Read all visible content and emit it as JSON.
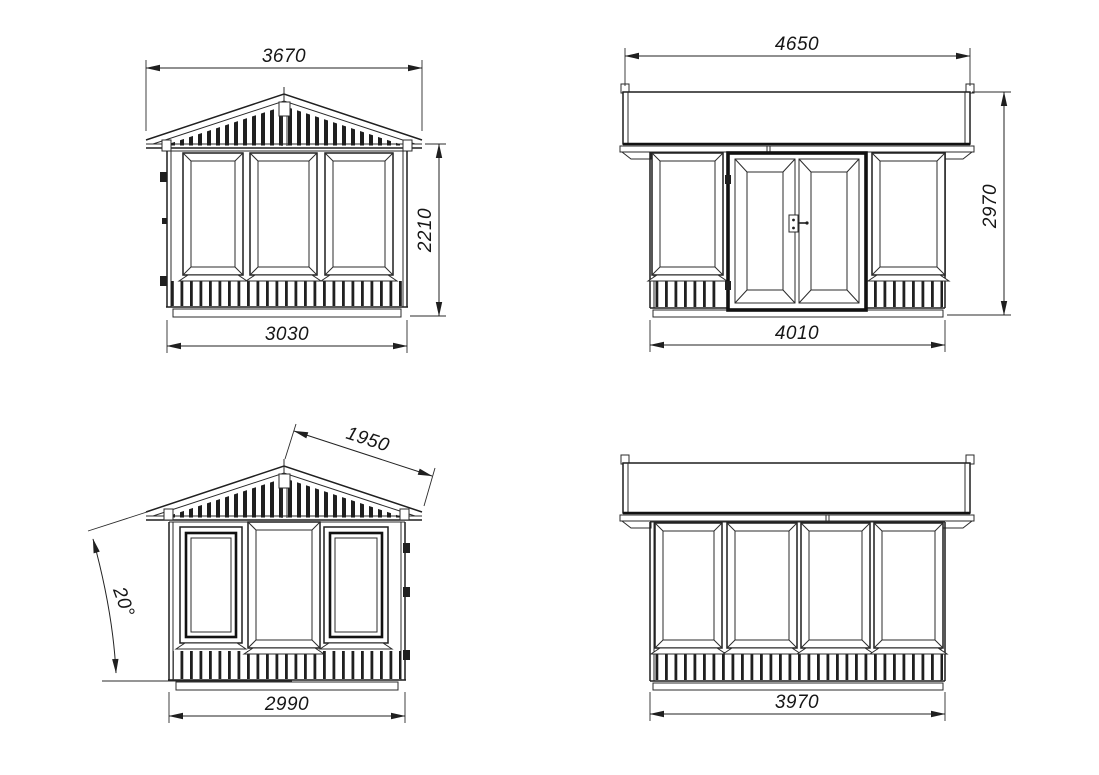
{
  "drawing": {
    "background_color": "#ffffff",
    "line_color": "#1f1f1f",
    "views": {
      "front_gable": {
        "dim_roof_width": "3670",
        "dim_wall_height": "2210",
        "dim_wall_width": "3030"
      },
      "entrance_side": {
        "dim_roof_length": "4650",
        "dim_total_height": "2970",
        "dim_wall_length": "4010"
      },
      "rear_gable": {
        "dim_roof_slope_length": "1950",
        "dim_roof_pitch_angle": "20°",
        "dim_wall_width": "2990"
      },
      "rear_side": {
        "dim_wall_length": "3970"
      }
    }
  }
}
